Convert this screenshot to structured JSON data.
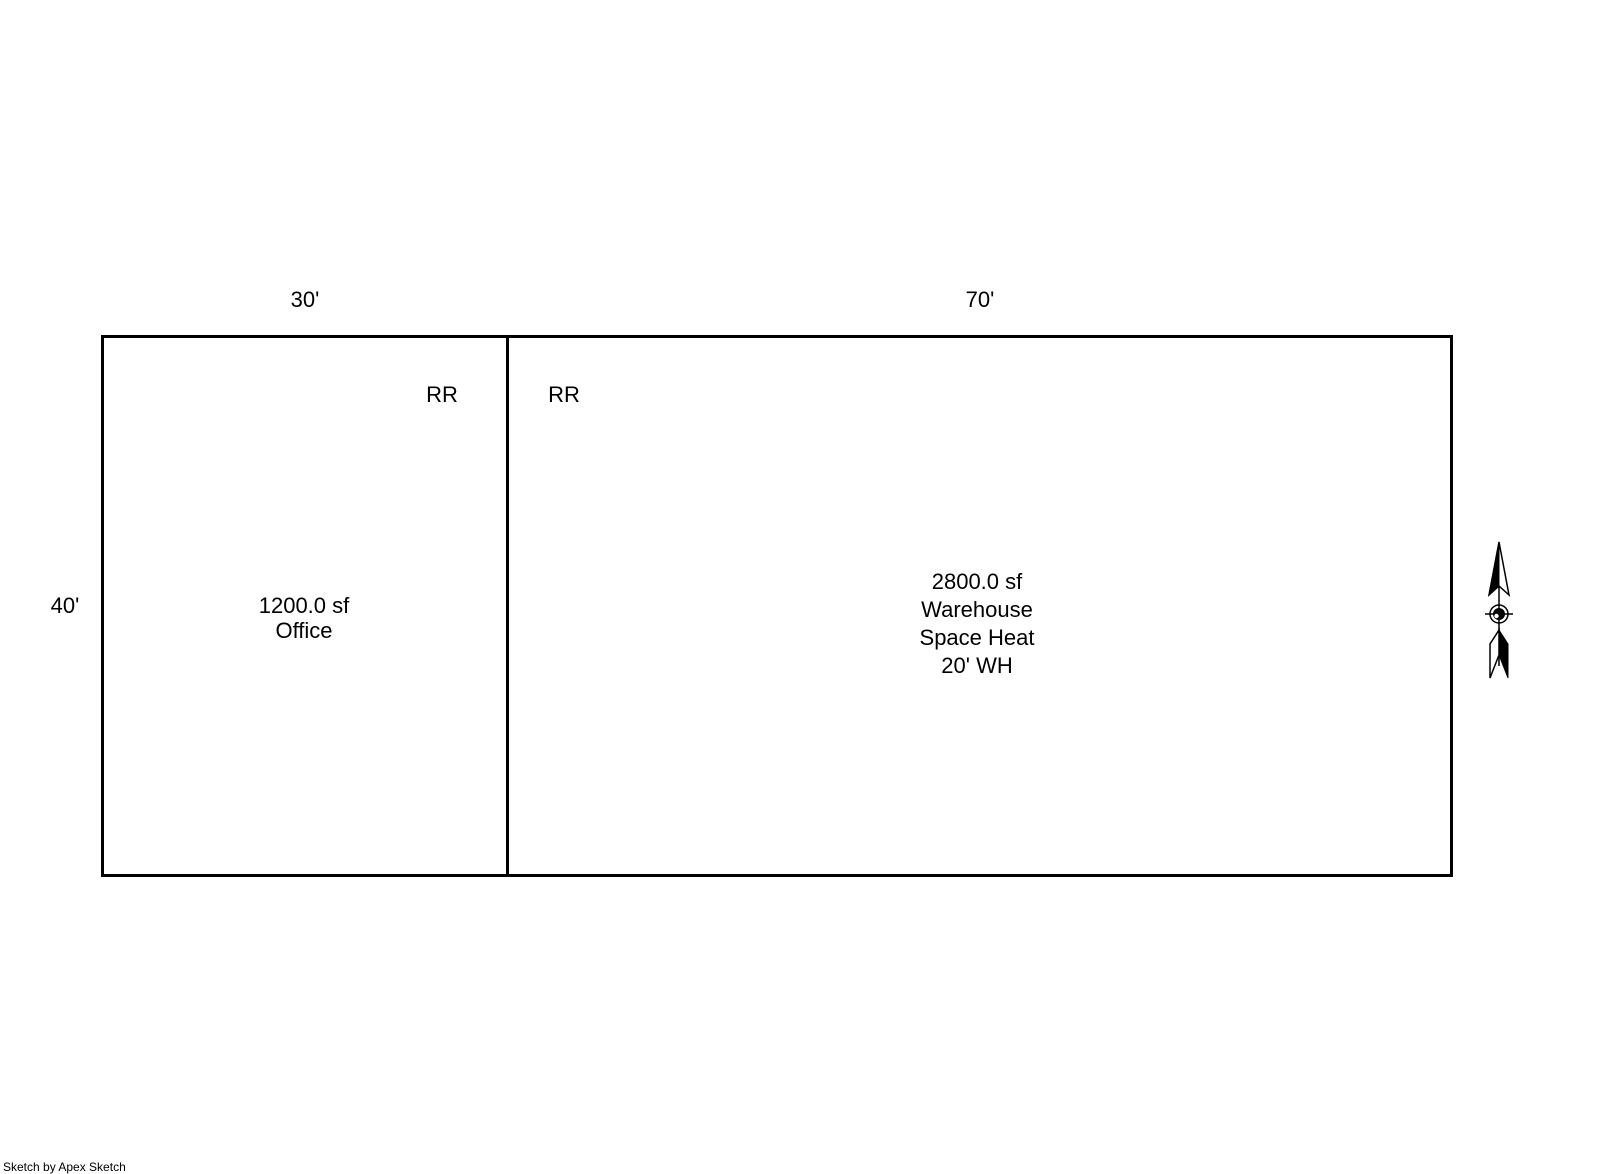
{
  "colors": {
    "ink": "#000000",
    "paper": "#ffffff"
  },
  "office": {
    "width_dim": "30'",
    "height_dim": "40'",
    "room_code": "RR",
    "area": "1200.0 sf",
    "label": "Office"
  },
  "warehouse": {
    "width_dim": "70'",
    "room_code": "RR",
    "area": "2800.0 sf",
    "label": "Warehouse",
    "heat_type": "Space Heat",
    "wall_height": "20' WH"
  },
  "icons": {
    "north_arrow": "compass-north-arrow"
  },
  "footer": {
    "credit": "Sketch by Apex Sketch"
  }
}
